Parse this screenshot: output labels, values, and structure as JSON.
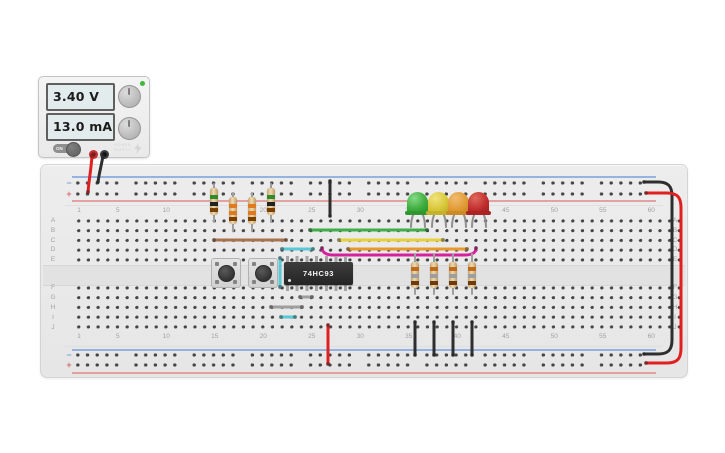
{
  "power_supply": {
    "voltage_display": "3.40 V",
    "current_display": "13.0 mA",
    "switch_label": "ON",
    "brand_line1": "POWER",
    "brand_line2": "SUPPLY",
    "indicator_color": "#3cb83c"
  },
  "breadboard": {
    "column_labels": [
      "1",
      "5",
      "10",
      "15",
      "20",
      "25",
      "30",
      "35",
      "40",
      "45",
      "50",
      "55",
      "60"
    ],
    "row_labels_top": [
      "A",
      "B",
      "C",
      "D",
      "E"
    ],
    "row_labels_bottom": [
      "F",
      "G",
      "H",
      "I",
      "J"
    ],
    "negative_symbol": "−",
    "positive_symbol": "+"
  },
  "ic": {
    "label": "74HC93"
  },
  "leds": {
    "green": "#3aaa3a",
    "yellow": "#d6c535",
    "orange": "#df9933",
    "red": "#bf2b2b"
  },
  "wire_colors": {
    "red": "#e02020",
    "black": "#2e2e2e",
    "green": "#3fae49",
    "yellow": "#e6d13b",
    "orange": "#e8992e",
    "magenta": "#d6219c",
    "cyan": "#5bc8d5",
    "brown": "#a8724d",
    "gray": "#9e9e9e"
  },
  "resistors": {
    "left_bands": [
      [
        "green",
        "black",
        "brown"
      ],
      [
        "orange",
        "orange",
        "brown"
      ],
      [
        "orange",
        "orange",
        "brown"
      ],
      [
        "green",
        "black",
        "brown"
      ]
    ],
    "right_bands": [
      [
        "orange",
        "gray",
        "brown"
      ],
      [
        "orange",
        "gray",
        "brown"
      ],
      [
        "orange",
        "gray",
        "brown"
      ],
      [
        "orange",
        "gray",
        "brown"
      ]
    ]
  }
}
